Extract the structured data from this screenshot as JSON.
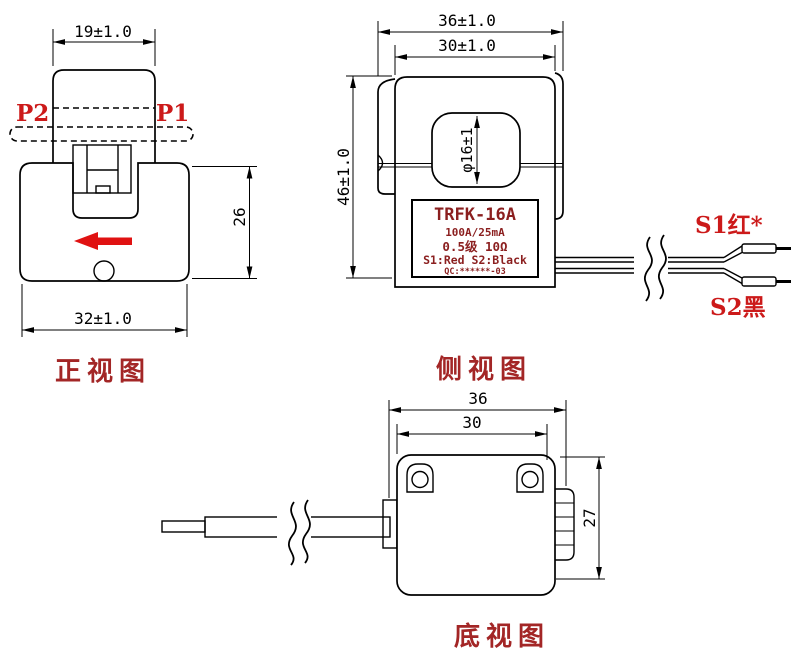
{
  "front_view": {
    "title": "正视图",
    "terminal_left": "P2",
    "terminal_right": "P1",
    "dim_top_width": "19±1.0",
    "dim_height": "26",
    "dim_bottom_width": "32±1.0"
  },
  "side_view": {
    "title": "侧视图",
    "dim_overall_width": "36±1.0",
    "dim_body_width": "30±1.0",
    "dim_height": "46±1.0",
    "dim_hole_diameter": "φ16±1",
    "nameplate": {
      "model": "TRFK-16A",
      "rating": "100A/25mA",
      "accuracy": "0.5级  10Ω",
      "wiring": "S1:Red  S2:Black",
      "qc": "QC:******-03"
    },
    "wire_label_s1": "S1红*",
    "wire_label_s2": "S2黑"
  },
  "bottom_view": {
    "title": "底视图",
    "dim_overall_width": "36",
    "dim_body_width": "30",
    "dim_height": "27"
  },
  "colors": {
    "line": "#000000",
    "label_red": "#cc1a1a",
    "title_red": "#a32626",
    "nameplate_red": "#8b1f1f",
    "arrow_red": "#e01212"
  }
}
